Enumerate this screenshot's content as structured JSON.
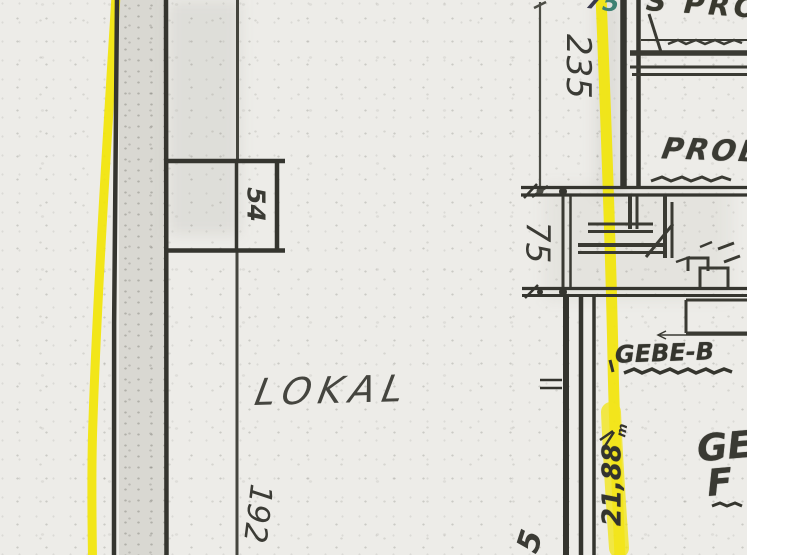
{
  "drawing": {
    "type": "scanned-architectural-floor-plan",
    "room_label": "LOKAL",
    "dimensions": {
      "d54": "54",
      "d192": "192",
      "d235": "235",
      "d75": "75",
      "d2188": "21,88",
      "d2188_unit": "m",
      "d5_fragment": "5",
      "top_fragment_7": "7",
      "top_fragment_5": "5"
    },
    "labels": {
      "top_right_fragment": "S PRO",
      "probe": "PROB",
      "gebe": "GEBE-B",
      "ge_fragment": "GE",
      "f_fragment": "F"
    },
    "colors": {
      "highlight_yellow": "#f2e506",
      "ink": "#3a3a34",
      "paper": "#edece8",
      "teal_mark": "#3e8173"
    }
  }
}
